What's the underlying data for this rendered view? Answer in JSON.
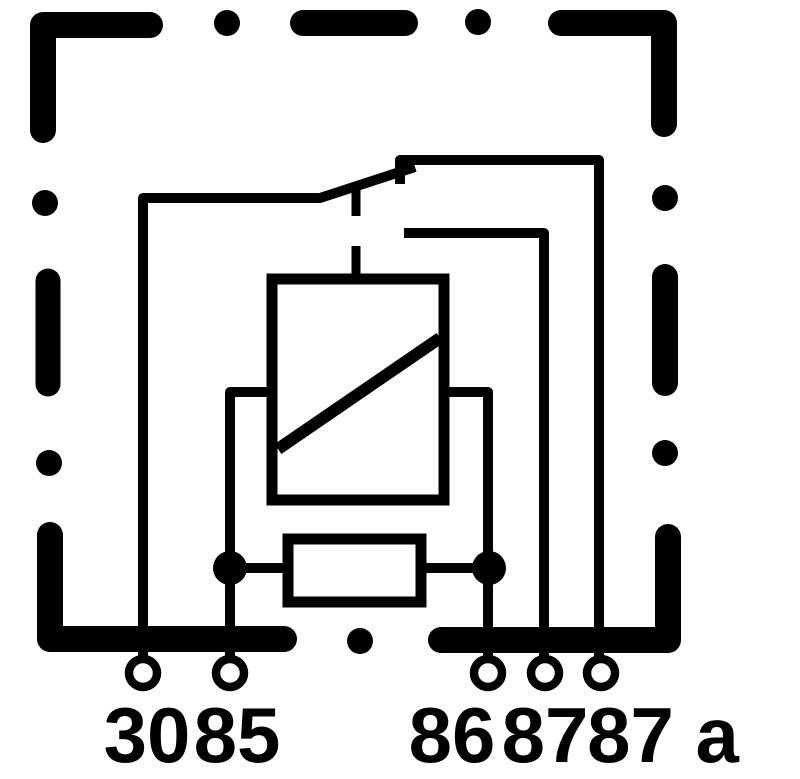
{
  "diagram": {
    "kind": "relay-wiring-schematic",
    "background": "#ffffff",
    "line_color": "#000000"
  },
  "terminals": [
    {
      "id": "30",
      "label": "30"
    },
    {
      "id": "85",
      "label": "85"
    },
    {
      "id": "86",
      "label": "86"
    },
    {
      "id": "87",
      "label": "87"
    },
    {
      "id": "87a",
      "label": "87 a"
    }
  ],
  "components": {
    "housing": "dashed-outline",
    "coil": "rectangle-with-diagonal",
    "resistor": "rectangle",
    "switch": "changeover-contact"
  }
}
